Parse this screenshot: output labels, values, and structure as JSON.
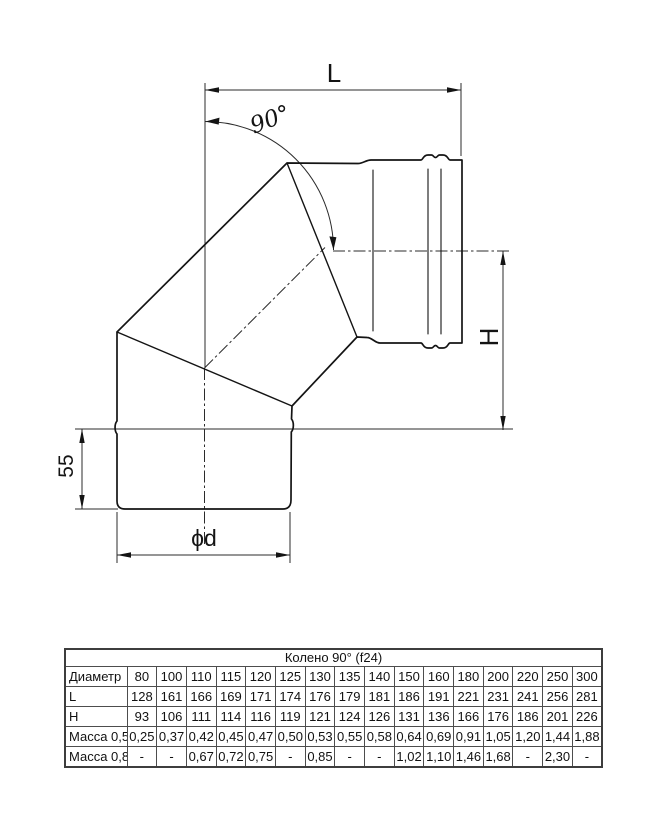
{
  "diagram": {
    "labels": {
      "length": "L",
      "angle": "90°",
      "height": "H",
      "collar": "55",
      "diameter": "ϕd"
    },
    "line_color": "#141414",
    "thin_line_color": "#2b2b2b"
  },
  "table": {
    "title": "Колено 90° (f24)",
    "rows": [
      {
        "label": "Диаметр",
        "values": [
          "80",
          "100",
          "110",
          "115",
          "120",
          "125",
          "130",
          "135",
          "140",
          "150",
          "160",
          "180",
          "200",
          "220",
          "250",
          "300"
        ]
      },
      {
        "label": "L",
        "values": [
          "128",
          "161",
          "166",
          "169",
          "171",
          "174",
          "176",
          "179",
          "181",
          "186",
          "191",
          "221",
          "231",
          "241",
          "256",
          "281"
        ]
      },
      {
        "label": "H",
        "values": [
          "93",
          "106",
          "111",
          "114",
          "116",
          "119",
          "121",
          "124",
          "126",
          "131",
          "136",
          "166",
          "176",
          "186",
          "201",
          "226"
        ]
      },
      {
        "label": "Масса 0,5",
        "values": [
          "0,25",
          "0,37",
          "0,42",
          "0,45",
          "0,47",
          "0,50",
          "0,53",
          "0,55",
          "0,58",
          "0,64",
          "0,69",
          "0,91",
          "1,05",
          "1,20",
          "1,44",
          "1,88"
        ]
      },
      {
        "label": "Масса 0,8",
        "values": [
          "-",
          "-",
          "0,67",
          "0,72",
          "0,75",
          "-",
          "0,85",
          "-",
          "-",
          "1,02",
          "1,10",
          "1,46",
          "1,68",
          "-",
          "2,30",
          "-"
        ]
      }
    ]
  }
}
